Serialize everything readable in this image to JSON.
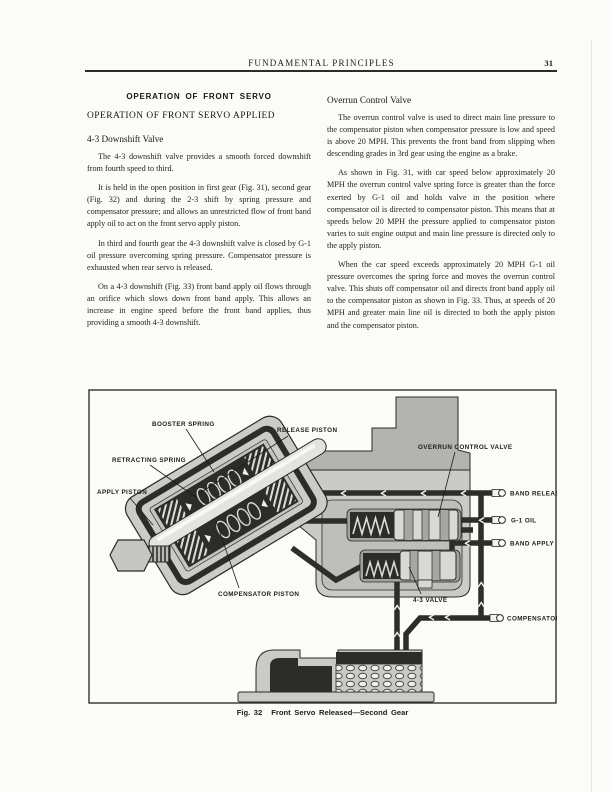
{
  "header": {
    "title": "FUNDAMENTAL PRINCIPLES",
    "page_number": "31"
  },
  "left_column": {
    "section_title": "OPERATION OF FRONT SERVO",
    "subsection_title": "OPERATION OF FRONT SERVO APPLIED",
    "heading": "4-3 Downshift Valve",
    "paragraphs": [
      "The 4-3 downshift valve provides a smooth forced downshift from fourth speed to third.",
      "It is held in the open position in first gear (Fig. 31), second gear (Fig. 32) and during the 2-3 shift by spring pressure and compensator pressure; and allows an unrestricted flow of front band apply oil to act on the front servo apply piston.",
      "In third and fourth gear the 4-3 downshift valve is closed by G-1 oil pressure overcoming spring pressure. Compensator pressure is exhausted when rear servo is released.",
      "On a 4-3 downshift (Fig. 33) front band apply oil flows through an orifice which slows down front band apply. This allows an increase in engine speed before the front band applies, thus providing a smooth 4-3 downshift."
    ]
  },
  "right_column": {
    "heading": "Overrun Control Valve",
    "paragraphs": [
      "The overrun control valve is used to direct main line pressure to the compensator piston when compensator pressure is low and speed is above 20 MPH. This prevents the front band from slipping when descending grades in 3rd gear using the engine as a brake.",
      "As shown in Fig. 31, with car speed below approximately 20 MPH the overrun control valve spring force is greater than the force exerted by G-1 oil and holds valve in the position where compensator oil is directed to compensator piston. This means that at speeds below 20 MPH the pressure applied to compensator piston varies to suit engine output and main line pressure is directed only to the apply piston.",
      "When the car speed exceeds approximately 20 MPH G-1 oil pressure overcomes the spring force and moves the overrun control valve. This shuts off compensator oil and directs front band apply oil to the compensator piston as shown in Fig. 33. Thus, at speeds of 20 MPH and greater main line oil is directed to both the apply piston and the compensator piston."
    ]
  },
  "figure": {
    "caption_number": "Fig. 32",
    "caption_title": "Front Servo Released—Second Gear",
    "labels": {
      "booster_spring": "BOOSTER SPRING",
      "release_piston": "RELEASE PISTON",
      "retracting_spring": "RETRACTING SPRING",
      "apply_piston": "APPLY PISTON",
      "compensator_piston": "COMPENSATOR PISTON",
      "overrun_control_valve": "OVERRUN CONTROL VALVE",
      "band_release": "BAND RELEASE",
      "g1_oil": "G-1 OIL",
      "band_apply": "BAND APPLY",
      "four_three_valve": "4-3 VALVE",
      "compensator": "COMPENSATOR"
    },
    "colors": {
      "ink": "#1d1d1b",
      "pipe_dark": "#2d2d2b",
      "casting_light": "#cacac8",
      "casting_mid": "#b3b3b1"
    }
  }
}
